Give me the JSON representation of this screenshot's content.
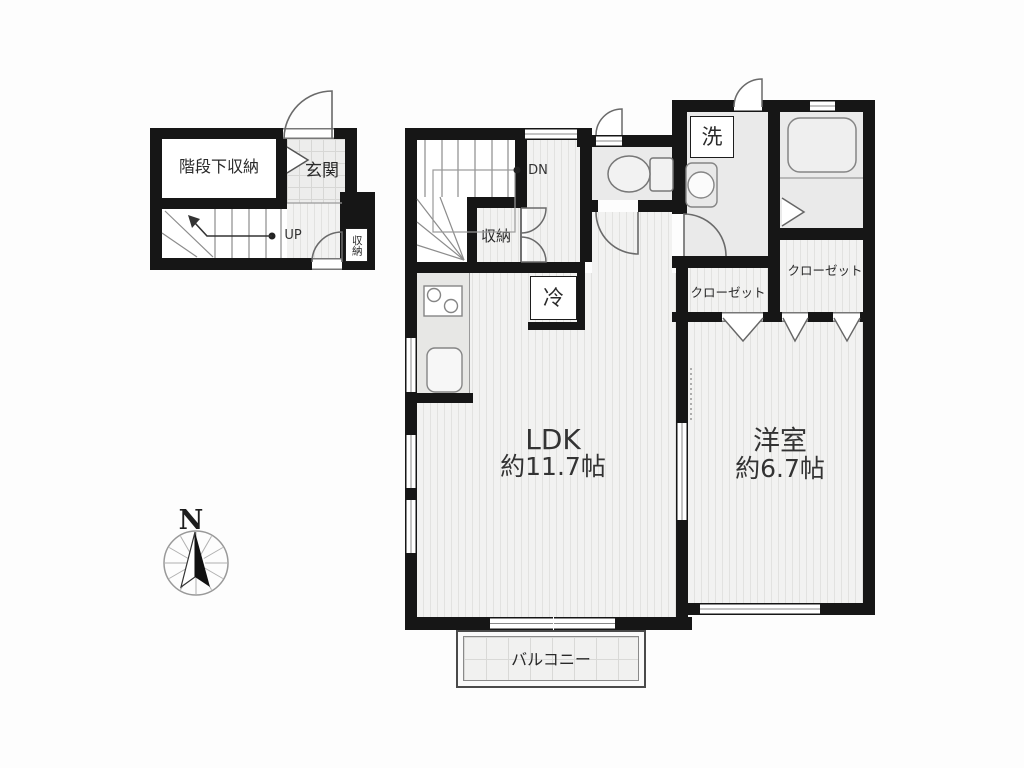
{
  "rooms": {
    "floor1": {
      "under_stair_storage": "階段下収納",
      "entrance": "玄関",
      "up": "UP",
      "storage": "収納"
    },
    "floor2": {
      "down": "DN",
      "storage": "収納",
      "washer": "洗",
      "refrigerator": "冷",
      "closet_left": "クローゼット",
      "closet_right": "クローゼット",
      "ldk_name": "LDK",
      "ldk_area": "約11.7帖",
      "western_name": "洋室",
      "western_area": "約6.7帖",
      "balcony": "バルコニー"
    },
    "compass": {
      "north": "N"
    }
  },
  "colors": {
    "wall": "#161616",
    "wood_floor": "#f2f2f1",
    "tile_floor": "#ededec",
    "fixture_line": "#777777"
  }
}
